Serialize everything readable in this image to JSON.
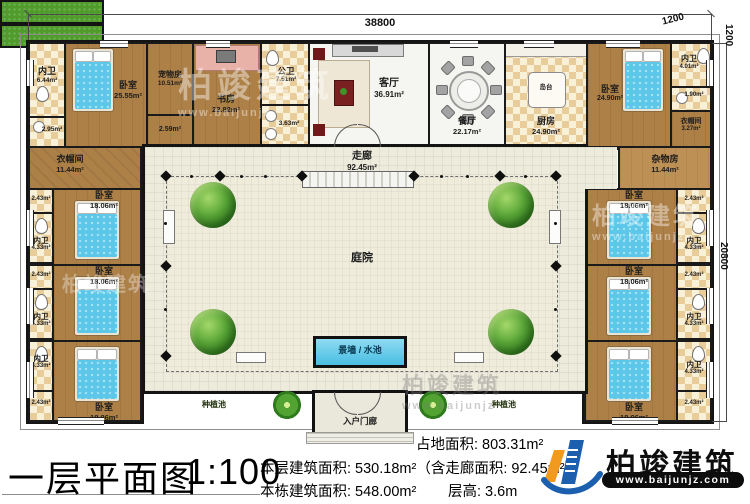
{
  "dimensions": {
    "top": "38800",
    "corner_a": "1200",
    "corner_b": "1200",
    "right": "20800"
  },
  "top_row": {
    "nw_bath": {
      "name": "内卫",
      "area": "6.44m²"
    },
    "nw_wash": {
      "area": "2.95m²"
    },
    "nw_bedroom": {
      "name": "卧室",
      "area": "25.55m²"
    },
    "pet_room": {
      "name": "宠物房",
      "area": "10.51m²"
    },
    "pet_hall": {
      "area": "2.59m²"
    },
    "study": {
      "name": "书房",
      "area": "22.82m²"
    },
    "public_bath": {
      "name": "公卫",
      "area": "7.51m²"
    },
    "public_wash": {
      "area": "3.63m²"
    },
    "living_room": {
      "name": "客厅",
      "area": "36.91m²"
    },
    "dining_room": {
      "name": "餐厅",
      "area": "22.17m²"
    },
    "kitchen": {
      "name": "厨房",
      "area": "24.90m²"
    },
    "island": {
      "name": "岛台"
    },
    "ne_bedroom": {
      "name": "卧室",
      "area": "24.90m²"
    },
    "ne_bath": {
      "name": "内卫",
      "area": "4.01m²"
    },
    "ne_wash": {
      "area": "1.90m²"
    },
    "ne_cloak": {
      "name": "衣帽间",
      "area": "3.27m²"
    }
  },
  "west_wing": {
    "cloak": {
      "name": "衣帽间",
      "area": "11.44m²"
    },
    "closet_area": "2.43m²",
    "bath": {
      "name": "内卫",
      "area": "4.33m²"
    },
    "bedroom": {
      "name": "卧室",
      "area": "18.06m²"
    }
  },
  "east_wing": {
    "storage": {
      "name": "杂物房",
      "area": "11.44m²"
    },
    "closet_area": "2.43m²",
    "bath": {
      "name": "内卫",
      "area": "4.33m²"
    },
    "bedroom": {
      "name": "卧室",
      "area": "18.06m²"
    }
  },
  "center": {
    "corridor": {
      "name": "走廊",
      "area": "92.45m²"
    },
    "courtyard": {
      "name": "庭院"
    },
    "water_feature": {
      "name": "景墙 / 水池"
    },
    "planter": {
      "name": "种植池"
    },
    "porch": {
      "name": "入户门廊"
    }
  },
  "title_block": {
    "title": "一层平面图",
    "scale": "1:100",
    "site_area": "占地面积: 803.31m²",
    "floor_area": "本层建筑面积: 530.18m²（含走廊面积: 92.45m²）",
    "building_area": "本栋建筑面积: 548.00m²",
    "floor_height": "层高: 3.6m"
  },
  "logo": {
    "company": "柏竣建筑",
    "website": "www.baijunjz.com"
  },
  "watermark": {
    "text": "柏竣建筑",
    "site": "www.baijunjz"
  }
}
